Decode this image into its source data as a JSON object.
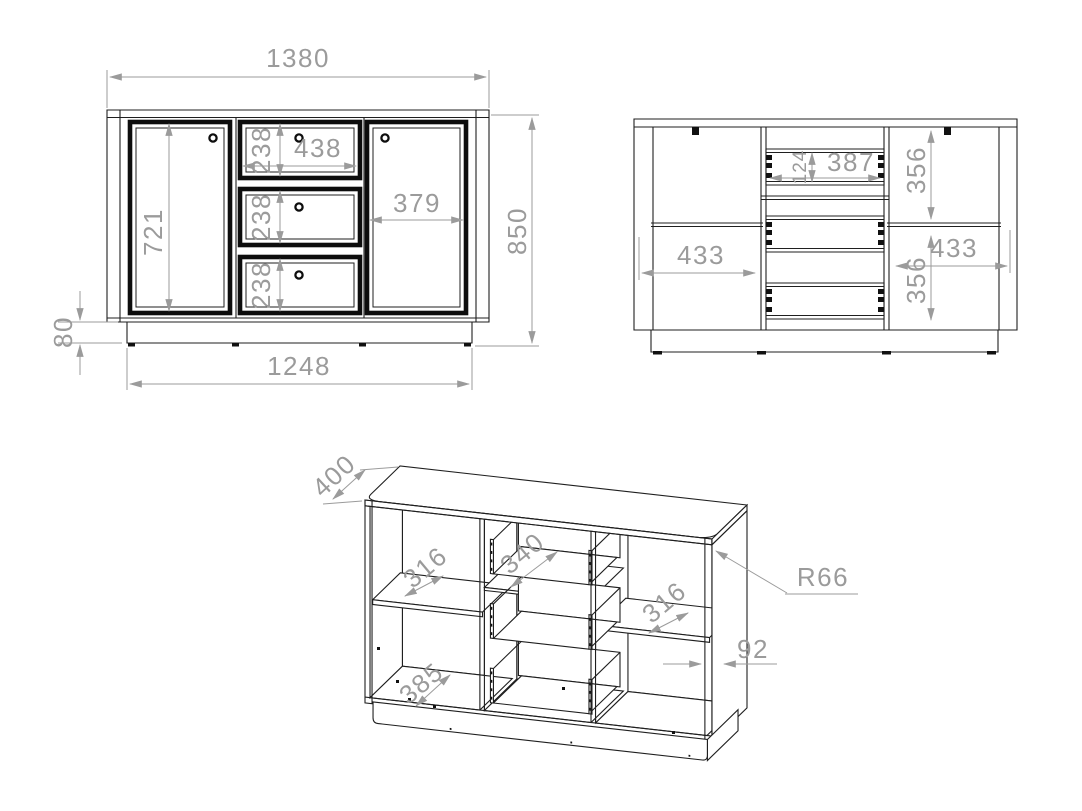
{
  "drawing": {
    "kind": "furniture technical drawing - sideboard, three views",
    "colors": {
      "line": "#1f1f1f",
      "dim_gray": "#9b9b9b",
      "background": "#ffffff"
    }
  },
  "front_view": {
    "overall_width": "1380",
    "overall_height": "850",
    "door_height": "721",
    "drawer_heights": [
      "238",
      "238",
      "238"
    ],
    "drawer_width": "438",
    "right_door_width": "379",
    "plinth_height": "80",
    "base_width": "1248"
  },
  "back_view": {
    "drawer_back_height": "124",
    "drawer_back_width": "387",
    "upper_section_height": "356",
    "left_shelf_width": "433",
    "right_shelf_width": "433",
    "lower_section_height": "356"
  },
  "iso_view": {
    "depth": "400",
    "left_shelf_depth": "316",
    "drawer_inner_width": "340",
    "right_shelf_depth": "316",
    "left_compartment_width": "385",
    "side_gap": "92",
    "corner_radius": "R66"
  }
}
